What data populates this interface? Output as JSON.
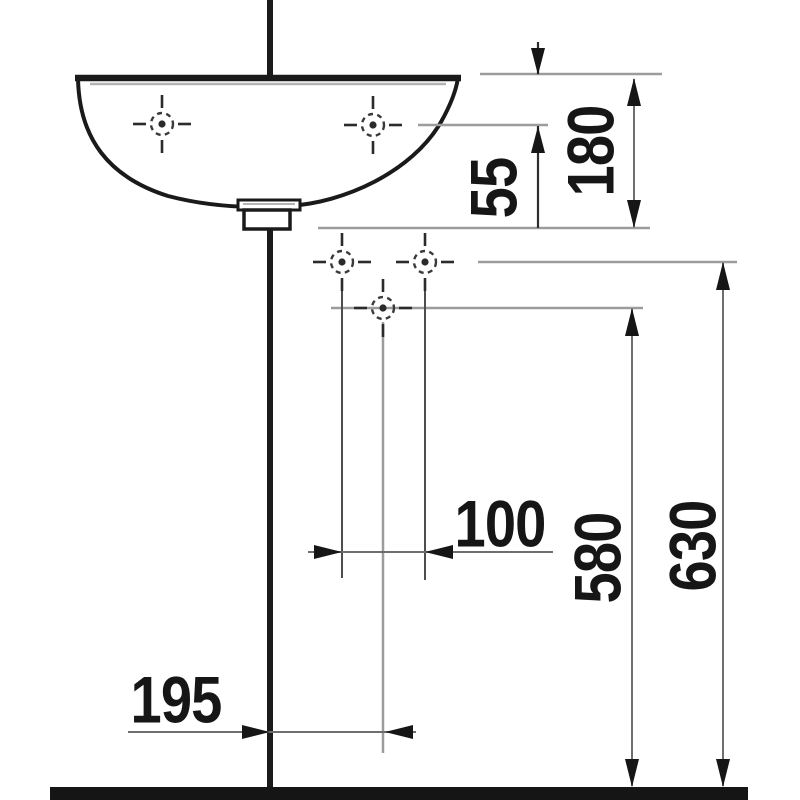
{
  "drawing": {
    "subject": "Wall-hung washbasin side elevation with installation dimensions",
    "dimensions": {
      "rim_to_taphole": "55",
      "basin_height": "180",
      "fixing_hole_spacing": "100",
      "outlet_height": "580",
      "fixing_hole_height": "630",
      "outlet_wall_offset": "195"
    },
    "markers": {
      "taphole_left": "tap-hole center mark",
      "taphole_right": "tap-hole center mark",
      "fixing_hole_left": "wall fixing hole mark",
      "fixing_hole_right": "wall fixing hole mark",
      "outlet_hole": "outlet / trap hole mark"
    },
    "colors": {
      "ink": "#1a1a1a",
      "dimension_line": "#6e6e6e",
      "extension_line": "#9c9c9c",
      "floor": "#151515",
      "background": "#ffffff"
    }
  }
}
